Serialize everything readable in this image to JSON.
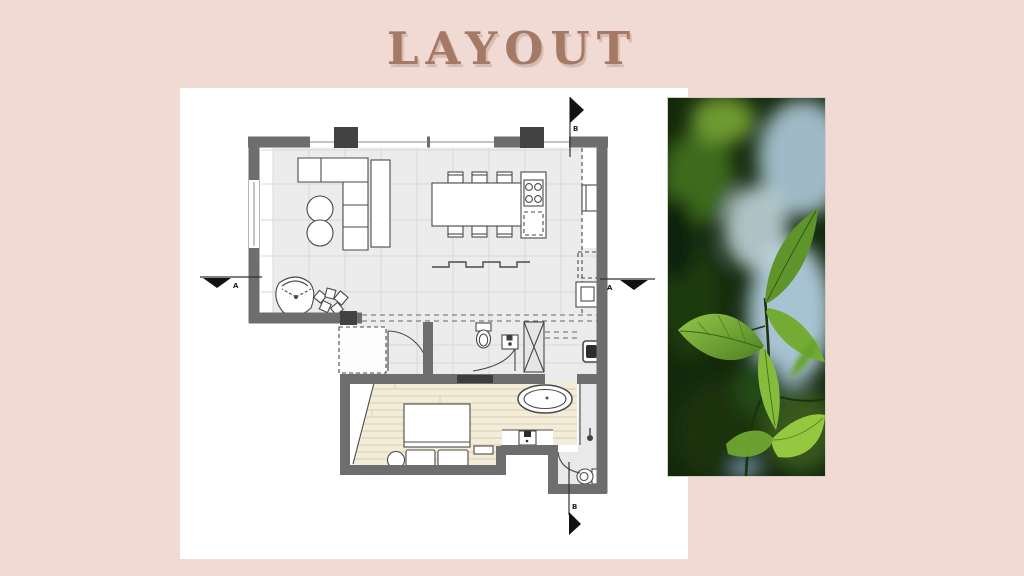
{
  "slide": {
    "title": "LAYOUT",
    "colors": {
      "background": "#F1DAD3",
      "panel": "#FFFFFF",
      "title_text": "#A47A67"
    }
  },
  "floor_plan": {
    "type": "apartment-floor-plan",
    "section_markers": [
      {
        "id": "left",
        "label": "A"
      },
      {
        "id": "right",
        "label": "A"
      },
      {
        "id": "top",
        "label": "B"
      },
      {
        "id": "bottom",
        "label": "B"
      }
    ],
    "colors": {
      "walls": "#6E6E6E",
      "columns": "#424242",
      "tile_floor": "#ECECEC",
      "wood_floor": "#F2ECD8",
      "furniture_line": "#4A4A4A"
    },
    "elements": [
      "l-shaped-sofa",
      "round-coffee-tables",
      "media-console",
      "lounge-chair",
      "plants",
      "dining-table-six-chairs",
      "kitchen-island-stove",
      "wall-shelf",
      "tall-cabinets",
      "entry-door",
      "guest-wc-toilet",
      "guest-wc-sink",
      "shaft-column",
      "washing-machine",
      "wardrobe",
      "double-bed",
      "bedside-table",
      "oval-bathtub",
      "vanity-sink",
      "shower-head",
      "wc-toilet"
    ]
  },
  "photo": {
    "type": "green-leaves-close-up",
    "colors": {
      "foliage_bright": "#8CC23E",
      "foliage_dark": "#14290C",
      "sky_bokeh": "#BED5DF"
    }
  }
}
